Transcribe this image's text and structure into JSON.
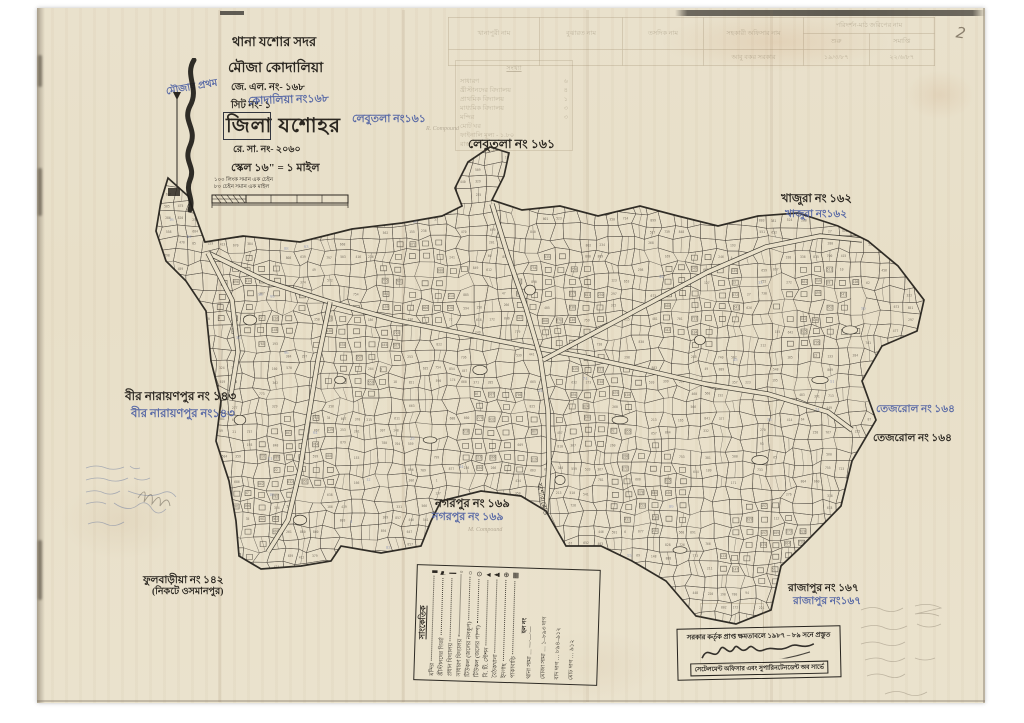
{
  "page": {
    "corner_mark": "2"
  },
  "title_block": {
    "thana": "থানা যশোর সদর",
    "mouza": "মৌজা কোদালিয়া",
    "jl_no": "জে. এল. নং- ১৬৮",
    "sheet_no": "সিট নং- ১",
    "sheet_blue": "কোদালিয়া নং১৬৮",
    "district": "জিলা যশোহর",
    "reg_no": "রে. সা. নং- ২০৬০",
    "scale": "স্কেল ১৬\" = ১ মাইল",
    "scale_note1": "১০০ লিংক সমান এক চেইন",
    "scale_note2": "৮০ চেইন সমান এক মাইল",
    "margin_blue": "মৌজার প্রথম"
  },
  "neighbors": {
    "lebutola_blue": "লেবুতলা নং১৬১",
    "lebutola": "লেবুতলা নং ১৬১",
    "khajura": "খাজুরা নং ১৬২",
    "khajura_blue": "খাজুরা নং১৬২",
    "bir_narayanpur": "বীর নারায়ণপুর নং ১৪৩",
    "bir_narayanpur_blue": "বীর নারায়ণপুর নং১৪৩",
    "tejrol_blue": "তেজরোল নং ১৬৪",
    "tejrol": "তেজরোল নং ১৬৪",
    "nagarpur": "নগরপুর নং ১৬৯",
    "nagarpur_blue": "নগরপুর নং ১৬৯",
    "phulbaria": "ফুলবাড়ীয়া নং ১৪২",
    "phulbaria_sub": "(নিকটে ওসমানপুর)",
    "rajapur": "রাজাপুর নং ১৬৭",
    "rajapur_blue": "রাজাপুর নং১৬৭"
  },
  "road_label": "যশোর রোড",
  "pencil_notes": {
    "note1": "R. Compound",
    "note2": "M. Compound"
  },
  "legend": {
    "title": "সাংকেতিক",
    "items": [
      {
        "label": "মন্দির",
        "symbol": "▮"
      },
      {
        "label": "খ্রীস্টানদের গির্জা",
        "symbol": "⚑"
      },
      {
        "label": "প্রধান বিদ্যালয়",
        "symbol": "❙"
      },
      {
        "label": "সাধারণ বিদ্যালয়",
        "symbol": "▫"
      },
      {
        "label": "টিউকল (জলের নলকূপ)",
        "symbol": "○"
      },
      {
        "label": "টিউকল (জলের পাম্প)",
        "symbol": "⊙"
      },
      {
        "label": "বি. টি. স্টেশন",
        "symbol": "▲"
      },
      {
        "label": "বৈঠকখানা",
        "symbol": "♟"
      },
      {
        "label": "ইদগাহ",
        "symbol": "⊕"
      },
      {
        "label": "পাকাবাড়ি",
        "symbol": "▦"
      }
    ],
    "mid": "হল নং",
    "footer": [
      "থানা সীমা … —·—·—",
      "মৌজা সীমা … ১–৮৯৩ দাগ",
      "বাদ দাগ … ৮৯৪–৯১২",
      "মোট দাগ … ৯১২"
    ]
  },
  "stamp": {
    "line1": "সরকার কর্তৃক প্রাপ্ত ক্ষমতাবলে ১৯৮৭ – ৮৯ সনে প্রস্তুত",
    "line2": "সেটেলমেন্ট অফিসার এবং সুপারিনটেনডেন্ট অব সার্ভে"
  },
  "survey_table": {
    "col1": "খানাপুরী নাম",
    "col2": "বুঝারত নাম",
    "col3": "তসদিক নাম",
    "col4": "সহকারী অফিসার নাম",
    "span_header": "পরিদর্শন-মাঠ জরিপের নাম",
    "sub1": "শুরু",
    "sub2": "সমাপ্তি",
    "r1c1": "",
    "r1c2": "",
    "r1c3": "",
    "r1c4": "আবু বকর সরকার",
    "r1c5": "১৯/৩/৮৭",
    "r1c6": "২২/৬/৮৭"
  },
  "stats_panel": {
    "title": "সংখ্যা",
    "lines": [
      {
        "label": "সাধারণ",
        "value": "৬"
      },
      {
        "label": "খ্রীস্টানদের বিদ্যালয়",
        "value": "৪"
      },
      {
        "label": "প্রাথমিক বিদ্যালয়",
        "value": "১"
      },
      {
        "label": "মাধ্যমিক বিদ্যালয়",
        "value": "৩"
      },
      {
        "label": "মন্দির",
        "value": "৩"
      },
      {
        "label": "মোট ঘর",
        "value": ""
      },
      {
        "label": "ফাইনালি মূল্য - ১.৮০",
        "value": ""
      },
      {
        "label": "রাস্তা",
        "value": ""
      }
    ]
  }
}
